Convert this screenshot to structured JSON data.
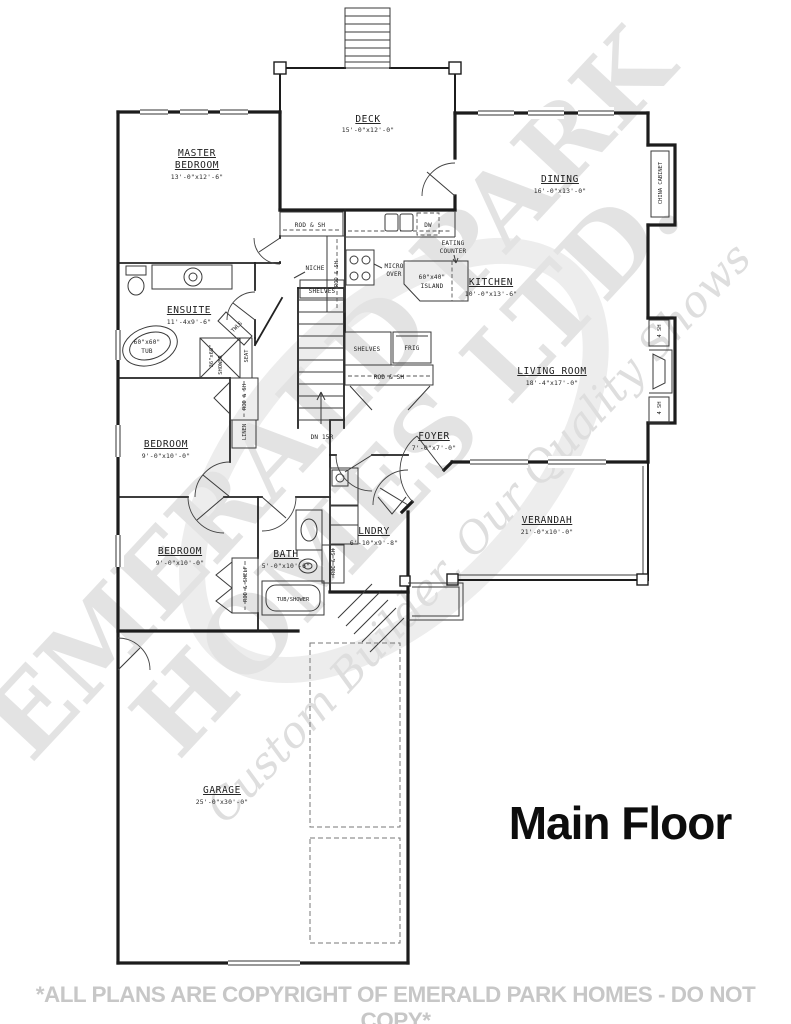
{
  "page": {
    "title": "Main Floor",
    "footer": "*ALL PLANS ARE COPYRIGHT OF EMERALD PARK HOMES - DO NOT COPY*"
  },
  "watermark": {
    "line1": "EMERALD PARK",
    "line2": "HOMES LTD.",
    "tagline": "Custom Builder, Our Quality Shows"
  },
  "rooms": {
    "deck": {
      "name": "DECK",
      "dims": "15'-0\"x12'-0\""
    },
    "master": {
      "name1": "MASTER",
      "name2": "BEDROOM",
      "dims": "13'-0\"x12'-6\""
    },
    "dining": {
      "name": "DINING",
      "dims": "16'-0\"x13'-0\""
    },
    "ensuite": {
      "name": "ENSUITE",
      "dims": "11'-4x9'-6\""
    },
    "kitchen": {
      "name": "KITCHEN",
      "dims": "10'-0\"x13'-6\""
    },
    "living": {
      "name": "LIVING ROOM",
      "dims": "18'-4\"x17'-0\""
    },
    "bedroom_mid": {
      "name": "BEDROOM",
      "dims": "9'-0\"x10'-0\""
    },
    "foyer": {
      "name": "FOYER",
      "dims": "7'-0\"x7'-0\""
    },
    "bedroom_low": {
      "name": "BEDROOM",
      "dims": "9'-0\"x10'-0\""
    },
    "bath": {
      "name": "BATH",
      "dims": "5'-0\"x10'-6\""
    },
    "laundry": {
      "name": "LNDRY",
      "dims": "6'-10\"x9'-8\""
    },
    "verandah": {
      "name": "VERANDAH",
      "dims": "21'-0\"x10'-0\""
    },
    "garage": {
      "name": "GARAGE",
      "dims": "25'-0\"x30'-0\""
    }
  },
  "fixtures": {
    "rod_sh": "ROD & SH",
    "rod_shelf": "ROD & SHELF",
    "shelves": "SHELVES",
    "niche": "NICHE",
    "linen": "LINEN",
    "micro1": "MICRO",
    "micro2": "OVER",
    "dw": "DW",
    "frig": "FRIG",
    "eating1": "EATING",
    "eating2": "COUNTER",
    "island1": "60\"x40\"",
    "island2": "ISLAND",
    "tub1": "60\"x60\"",
    "tub2": "TUB",
    "shower1": "36\"x60\"",
    "shower2": "SHOWER",
    "seat": "SEAT",
    "twls": "TWLS",
    "tub_shower": "TUB/SHOWER",
    "dn": "DN 15R",
    "china_cabinet": "CHINA CABINET",
    "four_sh": "4 SH"
  }
}
